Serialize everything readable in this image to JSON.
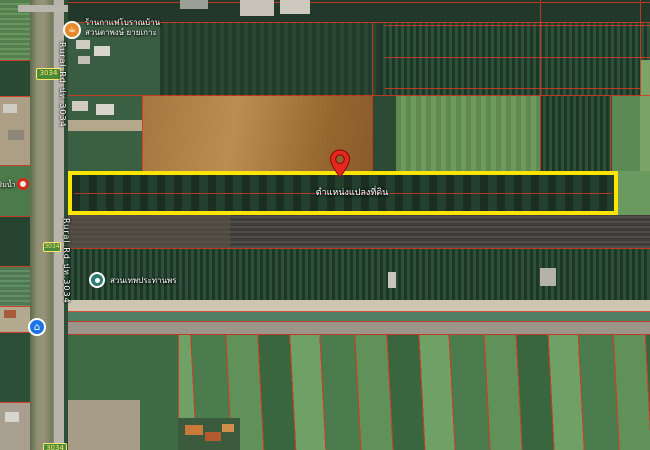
{
  "map": {
    "description": "satellite-map-land-plot-listing",
    "plot_marker": {
      "label": "ตำแหน่งแปลงที่ดิน"
    },
    "pois": {
      "coffee": {
        "name_line1": "ร้านกาแฟโบราณบ้าน",
        "name_line2": "สวนตาพงษ์ ยายเกาะ"
      },
      "park": {
        "name": "สวนเทพประทานพร"
      },
      "riverside": {
        "name": "ร้านริมน้ำ"
      }
    },
    "roads": {
      "upper_label": "Rural Rd ปท.3034",
      "lower_label": "Rural Rd ปท.3034",
      "badge_upper": "3034",
      "badge_mid": "3034",
      "badge_bottom": "3034"
    },
    "colors": {
      "highlight_rect": "#ffe400",
      "parcel_line": "#d63824",
      "pin": "#e8261c",
      "badge_bg": "#4a8a3a",
      "badge_border": "#ffe66a",
      "coffee_marker": "#e8882a",
      "lodging_marker": "#1a73e8",
      "park_marker": "#2e7d6e",
      "water": "#8f8f72",
      "road": "#b7b4ab"
    }
  }
}
